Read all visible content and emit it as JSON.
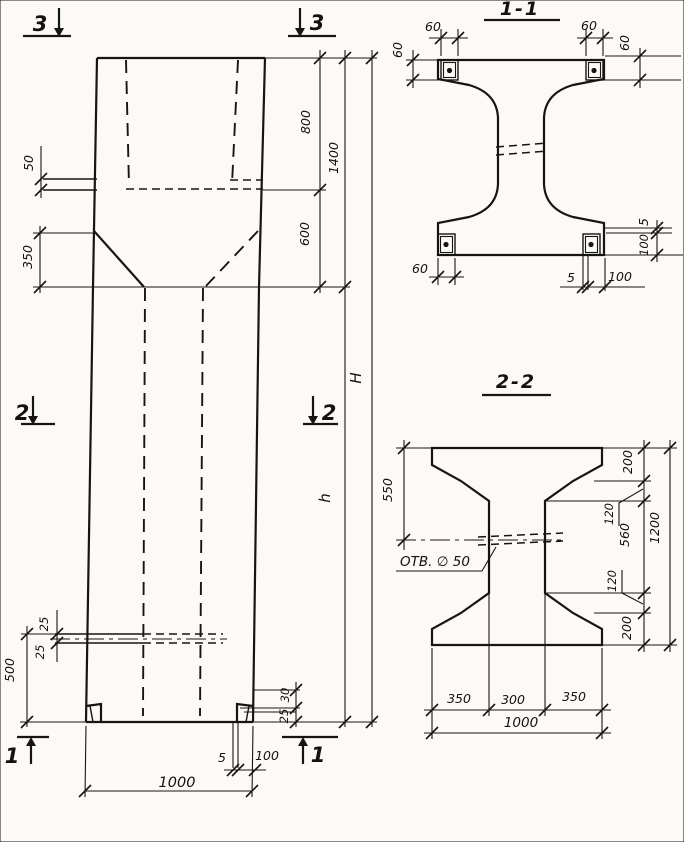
{
  "elevation": {
    "markers": {
      "s3_left": "3",
      "s3_right": "3",
      "s2_left": "2",
      "s2_right": "2",
      "s1_left": "1",
      "s1_right": "1"
    },
    "dims": {
      "ledge": "50",
      "top": "800",
      "top_total": "1400",
      "taper": "600",
      "taper_left": "350",
      "total_height": "H",
      "shaft_height": "h",
      "hole_up": "25",
      "hole_dn": "25",
      "hole_level": "500",
      "foot_upper": "30",
      "foot_lower": "25",
      "plate_gap": "5",
      "plate_width": "100",
      "base_width": "1000"
    }
  },
  "section_1_1": {
    "title": "1-1",
    "dims": {
      "plate_tl_w": "60",
      "plate_tl_h": "60",
      "plate_tr_w": "60",
      "plate_tr_h": "60",
      "plate_bl_w": "60",
      "plate_br_gap": "5",
      "plate_br_w": "100",
      "right_gap": "5",
      "right_w": "100"
    }
  },
  "section_2_2": {
    "title": "2-2",
    "hole_label": "ОТВ. ∅ 50",
    "dims": {
      "flange_half": "550",
      "top_flange": "200",
      "chamfer_top": "120",
      "web": "560",
      "chamfer_bottom": "120",
      "bottom_flange": "200",
      "height": "1200",
      "left": "350",
      "middle": "300",
      "right": "350",
      "width": "1000"
    }
  }
}
